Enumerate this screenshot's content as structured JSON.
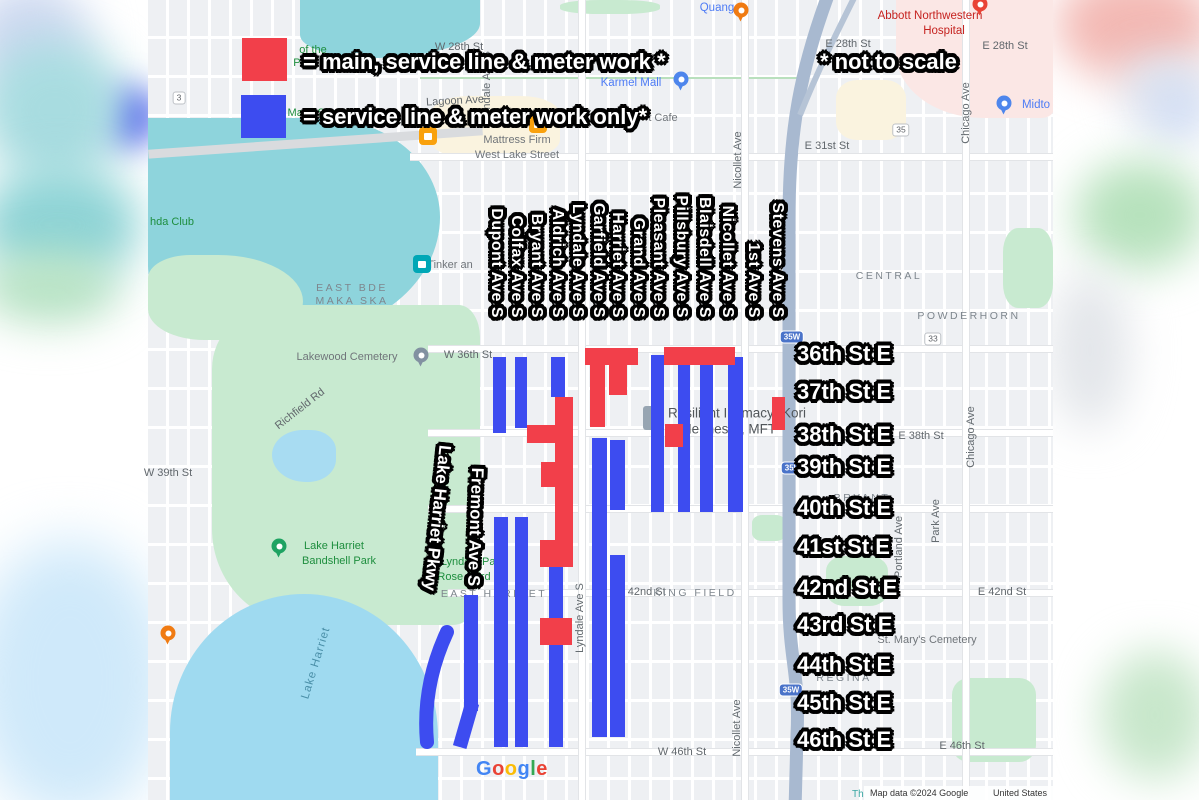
{
  "legend": {
    "red_label": "= main, service line & meter work *",
    "blue_label": "= service line & meter work only*",
    "note": "* not to scale",
    "red_color": "#f23f4a",
    "blue_color": "#3d4cf0"
  },
  "overlay": {
    "colors": {
      "red": "#f23f4a",
      "blue": "#3d4cf0"
    },
    "bars": [
      {
        "x": 493,
        "y": 357,
        "w": 13,
        "h": 76,
        "color": "blue"
      },
      {
        "x": 515,
        "y": 357,
        "w": 12,
        "h": 71,
        "color": "blue"
      },
      {
        "x": 551,
        "y": 357,
        "w": 14,
        "h": 40,
        "color": "blue"
      },
      {
        "x": 651,
        "y": 355,
        "w": 13,
        "h": 157,
        "color": "blue"
      },
      {
        "x": 678,
        "y": 365,
        "w": 12,
        "h": 147,
        "color": "blue"
      },
      {
        "x": 700,
        "y": 365,
        "w": 13,
        "h": 147,
        "color": "blue"
      },
      {
        "x": 728,
        "y": 357,
        "w": 15,
        "h": 155,
        "color": "blue"
      },
      {
        "x": 592,
        "y": 438,
        "w": 15,
        "h": 299,
        "color": "blue"
      },
      {
        "x": 610,
        "y": 440,
        "w": 15,
        "h": 70,
        "color": "blue"
      },
      {
        "x": 610,
        "y": 555,
        "w": 15,
        "h": 182,
        "color": "blue"
      },
      {
        "x": 549,
        "y": 567,
        "w": 14,
        "h": 180,
        "color": "blue"
      },
      {
        "x": 494,
        "y": 517,
        "w": 14,
        "h": 230,
        "color": "blue"
      },
      {
        "x": 515,
        "y": 517,
        "w": 13,
        "h": 230,
        "color": "blue"
      },
      {
        "x": 464,
        "y": 595,
        "w": 14,
        "h": 116,
        "color": "blue"
      },
      {
        "x": 459,
        "y": 702,
        "w": 14,
        "h": 46,
        "rot": 16,
        "color": "blue"
      },
      {
        "x": 585,
        "y": 348,
        "w": 53,
        "h": 17,
        "color": "red"
      },
      {
        "x": 590,
        "y": 365,
        "w": 15,
        "h": 62,
        "color": "red"
      },
      {
        "x": 609,
        "y": 365,
        "w": 18,
        "h": 30,
        "color": "red"
      },
      {
        "x": 664,
        "y": 347,
        "w": 71,
        "h": 18,
        "color": "red"
      },
      {
        "x": 665,
        "y": 424,
        "w": 18,
        "h": 23,
        "color": "red"
      },
      {
        "x": 772,
        "y": 397,
        "w": 13,
        "h": 33,
        "color": "red"
      },
      {
        "x": 555,
        "y": 397,
        "w": 18,
        "h": 170,
        "color": "red"
      },
      {
        "x": 527,
        "y": 425,
        "w": 28,
        "h": 18,
        "color": "red"
      },
      {
        "x": 541,
        "y": 462,
        "w": 14,
        "h": 25,
        "color": "red"
      },
      {
        "x": 540,
        "y": 540,
        "w": 15,
        "h": 27,
        "color": "red"
      },
      {
        "x": 540,
        "y": 618,
        "w": 32,
        "h": 27,
        "color": "red"
      }
    ],
    "arc": {
      "d": "M 447 632 Q 422 686 427 742",
      "color": "blue",
      "width": 14
    }
  },
  "avenue_labels": [
    {
      "text": "Dupont Ave S",
      "cx": 496
    },
    {
      "text": "Colfax Ave S",
      "cx": 516
    },
    {
      "text": "Bryant Ave S",
      "cx": 536
    },
    {
      "text": "Aldrich Ave S",
      "cx": 557
    },
    {
      "text": "Lyndale Ave S",
      "cx": 577
    },
    {
      "text": "Garfield Ave S",
      "cx": 598
    },
    {
      "text": "Harriet Ave S",
      "cx": 617
    },
    {
      "text": "Grand Ave S",
      "cx": 638
    },
    {
      "text": "Pleasant Ave S",
      "cx": 658
    },
    {
      "text": "Pillsbury Ave S",
      "cx": 681
    },
    {
      "text": "Blaisdell Ave S",
      "cx": 704
    },
    {
      "text": "Nicollet Ave S",
      "cx": 727
    },
    {
      "text": "1st Ave S",
      "cx": 753
    },
    {
      "text": "Stevens Ave S",
      "cx": 777
    }
  ],
  "street_labels": [
    {
      "text": "36th St E",
      "y": 354
    },
    {
      "text": "37th St E",
      "y": 392
    },
    {
      "text": "38th St E",
      "y": 435
    },
    {
      "text": "39th St E",
      "y": 467
    },
    {
      "text": "40th St E",
      "y": 508
    },
    {
      "text": "41st St E",
      "y": 547
    },
    {
      "text": "42nd St E",
      "y": 588
    },
    {
      "text": "43rd St E",
      "y": 625
    },
    {
      "text": "44th St E",
      "y": 665
    },
    {
      "text": "45th St E",
      "y": 703
    },
    {
      "text": "46th St E",
      "y": 740
    }
  ],
  "diagonal_labels": [
    {
      "text": "Lake Harriet Pkwy",
      "x": 437,
      "y": 518,
      "rot": 96
    },
    {
      "text": "Fremont Ave S",
      "x": 475,
      "y": 527,
      "rot": 92
    }
  ],
  "map_labels": [
    {
      "t": "W 28th St",
      "x": 459,
      "y": 47,
      "cls": "st"
    },
    {
      "t": "E 28th St",
      "x": 848,
      "y": 44,
      "cls": "st"
    },
    {
      "t": "E 28th St",
      "x": 1005,
      "y": 46,
      "cls": "st"
    },
    {
      "t": "Lagoon Ave",
      "x": 455,
      "y": 101,
      "cls": "st",
      "rot": -3
    },
    {
      "t": "E 31st St",
      "x": 827,
      "y": 146,
      "cls": "st"
    },
    {
      "t": "W 36th St",
      "x": 468,
      "y": 355,
      "cls": "st"
    },
    {
      "t": "E 38th St",
      "x": 921,
      "y": 436,
      "cls": "st"
    },
    {
      "t": "W 39th St",
      "x": 168,
      "y": 473,
      "cls": "st"
    },
    {
      "t": "W 42nd St",
      "x": 640,
      "y": 592,
      "cls": "st"
    },
    {
      "t": "E 42nd St",
      "x": 1002,
      "y": 592,
      "cls": "st"
    },
    {
      "t": "W 46th St",
      "x": 682,
      "y": 752,
      "cls": "st"
    },
    {
      "t": "E 46th St",
      "x": 962,
      "y": 746,
      "cls": "st"
    },
    {
      "t": "Richfield Rd",
      "x": 300,
      "y": 409,
      "cls": "st",
      "rot": -38
    },
    {
      "t": "Lyndale Ave S",
      "x": 487,
      "y": 86,
      "cls": "stv"
    },
    {
      "t": "Nicollet Ave",
      "x": 738,
      "y": 160,
      "cls": "stv"
    },
    {
      "t": "Chicago Ave",
      "x": 966,
      "y": 113,
      "cls": "stv"
    },
    {
      "t": "Lyndale Ave S",
      "x": 580,
      "y": 618,
      "cls": "stv"
    },
    {
      "t": "Nicollet Ave",
      "x": 737,
      "y": 728,
      "cls": "stv"
    },
    {
      "t": "Chicago Ave",
      "x": 971,
      "y": 437,
      "cls": "stv"
    },
    {
      "t": "Park Ave",
      "x": 936,
      "y": 521,
      "cls": "stv"
    },
    {
      "t": "Portland Ave",
      "x": 899,
      "y": 547,
      "cls": "stv"
    },
    {
      "t": "EAST BDE",
      "x": 352,
      "y": 288,
      "cls": "hood"
    },
    {
      "t": "MAKA SKA",
      "x": 352,
      "y": 301,
      "cls": "hood"
    },
    {
      "t": "CENTRAL",
      "x": 889,
      "y": 276,
      "cls": "hood"
    },
    {
      "t": "POWDERHORN",
      "x": 969,
      "y": 316,
      "cls": "hood"
    },
    {
      "t": "BRYANT",
      "x": 862,
      "y": 498,
      "cls": "hood"
    },
    {
      "t": "REGINA",
      "x": 844,
      "y": 678,
      "cls": "hood"
    },
    {
      "t": "EAST HARRIET",
      "x": 494,
      "y": 594,
      "cls": "hood"
    },
    {
      "t": "KING FIELD",
      "x": 695,
      "y": 593,
      "cls": "hood"
    },
    {
      "t": "of the",
      "x": 313,
      "y": 50,
      "cls": "g"
    },
    {
      "t": "Pa",
      "x": 300,
      "y": 63,
      "cls": "g"
    },
    {
      "t": "Maka Ska",
      "x": 312,
      "y": 113,
      "cls": "g"
    },
    {
      "t": "hda Club",
      "x": 172,
      "y": 222,
      "cls": "g"
    },
    {
      "t": "Lake Harriet",
      "x": 334,
      "y": 546,
      "cls": "g"
    },
    {
      "t": "Bandshell Park",
      "x": 339,
      "y": 561,
      "cls": "g"
    },
    {
      "t": "Lyndale Par",
      "x": 470,
      "y": 562,
      "cls": "g"
    },
    {
      "t": "Rose Gard",
      "x": 464,
      "y": 577,
      "cls": "g"
    },
    {
      "t": "Quang",
      "x": 717,
      "y": 8,
      "cls": "b"
    },
    {
      "t": "Karmel Mall",
      "x": 631,
      "y": 83,
      "cls": "b"
    },
    {
      "t": "Midto",
      "x": 1036,
      "y": 105,
      "cls": "b"
    },
    {
      "t": "Abbott Northwestern",
      "x": 930,
      "y": 16,
      "cls": "r"
    },
    {
      "t": "Hospital",
      "x": 944,
      "y": 31,
      "cls": "r"
    },
    {
      "t": "t Cafe",
      "x": 663,
      "y": 118,
      "cls": "poi"
    },
    {
      "t": "Mattress Firm",
      "x": 517,
      "y": 140,
      "cls": "poi"
    },
    {
      "t": "West Lake Street",
      "x": 517,
      "y": 155,
      "cls": "poi"
    },
    {
      "t": "Tinker an",
      "x": 450,
      "y": 265,
      "cls": "poi"
    },
    {
      "t": "Lakewood Cemetery",
      "x": 347,
      "y": 357,
      "cls": "poi"
    },
    {
      "t": "St. Mary's Cemetery",
      "x": 927,
      "y": 640,
      "cls": "poi"
    },
    {
      "t": "Resilient Intimacy- Kori",
      "x": 737,
      "y": 413,
      "cls": "poib"
    },
    {
      "t": "Hennessy, MFT",
      "x": 729,
      "y": 429,
      "cls": "poib"
    },
    {
      "t": "Lake Harriet",
      "x": 316,
      "y": 663,
      "cls": "wtr",
      "rot": -73
    }
  ],
  "shields": [
    {
      "t": "3",
      "x": 179,
      "y": 98,
      "type": "rt"
    },
    {
      "t": "35",
      "x": 901,
      "y": 130,
      "type": "rt"
    },
    {
      "t": "33",
      "x": 933,
      "y": 339,
      "type": "rt"
    },
    {
      "t": "35W",
      "x": 792,
      "y": 337,
      "type": "iw"
    },
    {
      "t": "35W",
      "x": 793,
      "y": 468,
      "type": "iw"
    },
    {
      "t": "35W",
      "x": 791,
      "y": 690,
      "type": "iw"
    }
  ],
  "pois": [
    {
      "kind": "pin",
      "color": "#F07B12",
      "x": 741,
      "y": 10,
      "name": "restaurant-pin-quang"
    },
    {
      "kind": "pin",
      "color": "#4E86EC",
      "x": 681,
      "y": 79,
      "name": "shopping-pin-karmel-mall"
    },
    {
      "kind": "pin",
      "color": "#4E86EC",
      "x": 1004,
      "y": 103,
      "name": "shopping-pin-midtown"
    },
    {
      "kind": "pin",
      "color": "#8291A1",
      "x": 421,
      "y": 355,
      "name": "cemetery-pin-lakewood"
    },
    {
      "kind": "pin",
      "color": "#1EA362",
      "x": 279,
      "y": 546,
      "name": "park-pin-bandshell"
    },
    {
      "kind": "pin",
      "color": "#E94335",
      "x": 980,
      "y": 4,
      "name": "hospital-pin-abbott"
    },
    {
      "kind": "pin",
      "color": "#F07B12",
      "x": 168,
      "y": 633,
      "name": "restaurant-pin-lake"
    },
    {
      "kind": "sq",
      "color": "#F9A10D",
      "x": 428,
      "y": 136,
      "name": "coffee-poi"
    },
    {
      "kind": "sq",
      "color": "#F9A10D",
      "x": 538,
      "y": 124,
      "name": "store-poi"
    },
    {
      "kind": "sq",
      "color": "#00A7B6",
      "x": 422,
      "y": 264,
      "name": "art-poi-tinker"
    },
    {
      "kind": "bld",
      "color": "#97a5b2",
      "x": 649,
      "y": 418,
      "name": "building-icon"
    }
  ],
  "google_logo": {
    "letters": [
      [
        "G",
        "#4285F4"
      ],
      [
        "o",
        "#EA4335"
      ],
      [
        "o",
        "#FBBC05"
      ],
      [
        "g",
        "#4285F4"
      ],
      [
        "l",
        "#34A853"
      ],
      [
        "e",
        "#EA4335"
      ]
    ]
  },
  "attribution": {
    "left": "Th",
    "text": "Map data ©2024 Google",
    "country": "United States"
  }
}
